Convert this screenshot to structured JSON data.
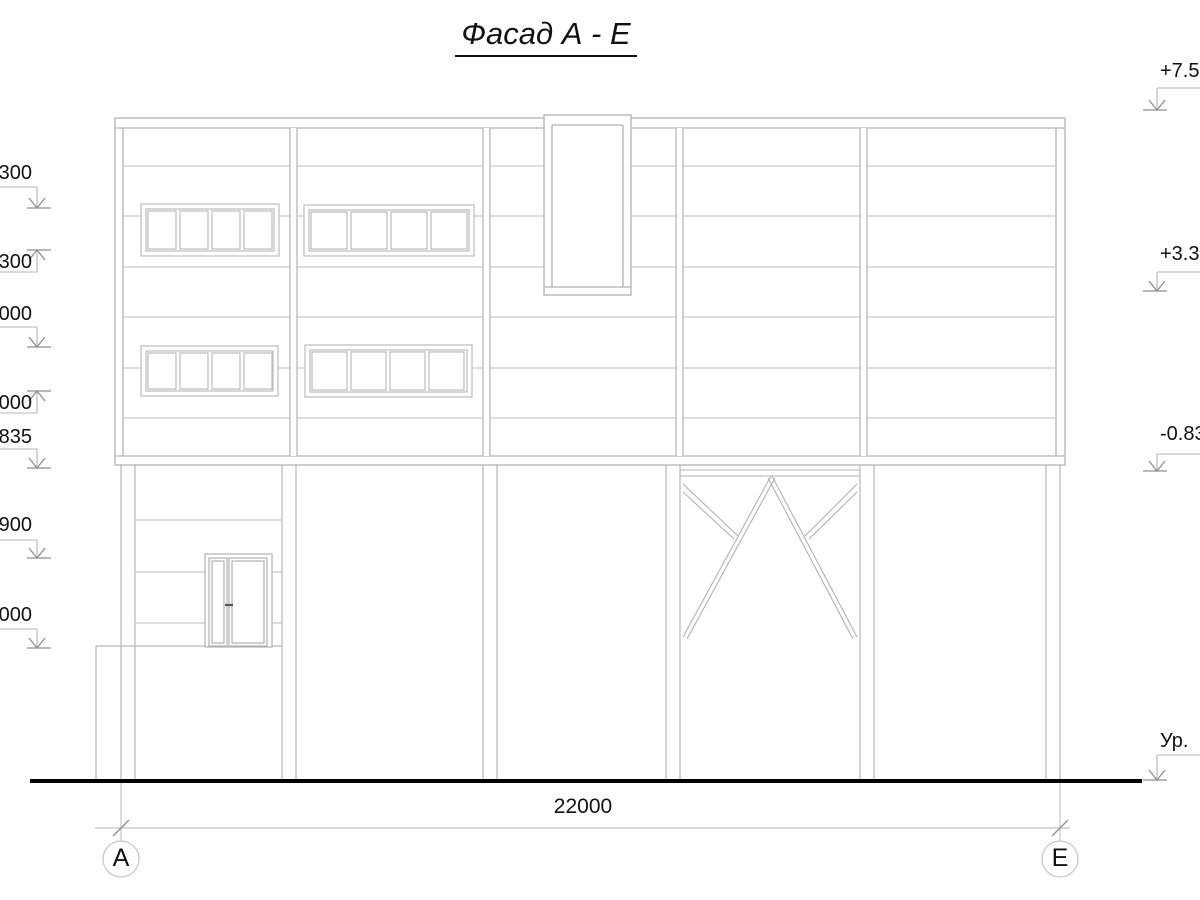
{
  "title": "Фасад А - Е",
  "elevation_marks_left": [
    {
      "label": "300",
      "direction": "down"
    },
    {
      "label": ".300",
      "direction": "up"
    },
    {
      "label": "000",
      "direction": "down"
    },
    {
      "label": "000",
      "direction": "up"
    },
    {
      "label": ".835",
      "direction": "down"
    },
    {
      "label": ".900",
      "direction": "down"
    },
    {
      "label": ".000",
      "direction": "down"
    }
  ],
  "elevation_marks_right": [
    {
      "label": "+7.50"
    },
    {
      "label": "+3.30"
    },
    {
      "label": "-0.83"
    },
    {
      "label": "Ур."
    }
  ],
  "dimension": {
    "value": "22000"
  },
  "axes": {
    "left": "А",
    "right": "Е"
  },
  "drawing": {
    "type": "architectural-facade-elevation",
    "windows_upper_floor": 4,
    "window_panes_each": 4,
    "door_leaves": 2,
    "gate_bays_with_bracing": 1,
    "overall_width_mm": "22000"
  },
  "colors": {
    "line": "#b2b2b2",
    "siding": "#c9c9c9",
    "arrow": "#8f8f8f",
    "ground": "#000000",
    "text": "#111111"
  }
}
